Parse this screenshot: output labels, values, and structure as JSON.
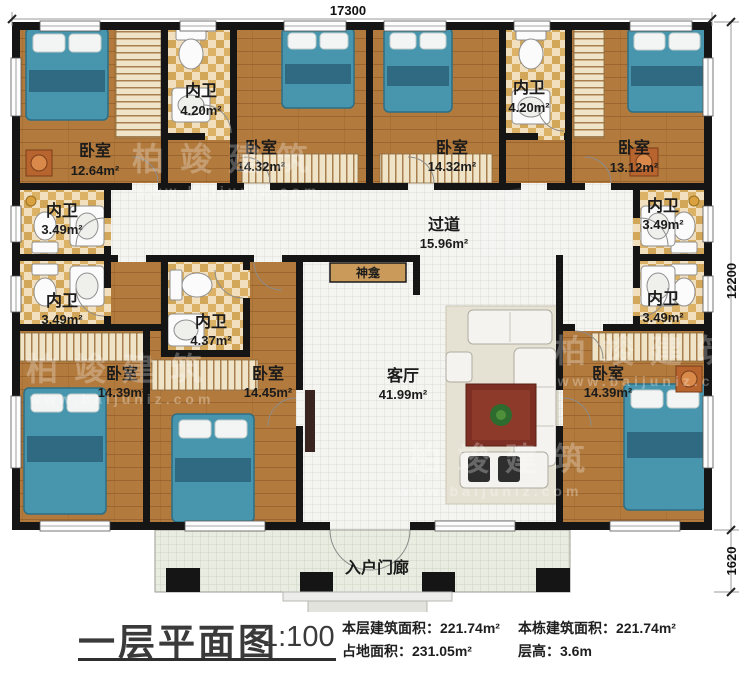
{
  "dims": {
    "top": "17300",
    "right_main": "12200",
    "right_porch": "1620"
  },
  "rooms": {
    "bedroom_tl": {
      "name": "卧室",
      "area": "12.64m²"
    },
    "bath_tl": {
      "name": "内卫",
      "area": "4.20m²"
    },
    "bedroom_t2": {
      "name": "卧室",
      "area": "14.32m²"
    },
    "bedroom_t3": {
      "name": "卧室",
      "area": "14.32m²"
    },
    "bath_tr": {
      "name": "内卫",
      "area": "4.20m²"
    },
    "bedroom_tr": {
      "name": "卧室",
      "area": "13.12m²"
    },
    "bath_l1": {
      "name": "内卫",
      "area": "3.49m²"
    },
    "bath_l2": {
      "name": "内卫",
      "area": "3.49m²"
    },
    "corridor": {
      "name": "过道",
      "area": "15.96m²"
    },
    "shrine": {
      "name": "神龛"
    },
    "bath_mid": {
      "name": "内卫",
      "area": "4.37m²"
    },
    "bedroom_mid": {
      "name": "卧室",
      "area": "14.45m²"
    },
    "living": {
      "name": "客厅",
      "area": "41.99m²"
    },
    "bath_r1": {
      "name": "内卫",
      "area": "3.49m²"
    },
    "bath_r2": {
      "name": "内卫",
      "area": "3.49m²"
    },
    "bedroom_bl": {
      "name": "卧室",
      "area": "14.39m²"
    },
    "bedroom_br": {
      "name": "卧室",
      "area": "14.39m²"
    },
    "porch": {
      "name": "入户门廊"
    }
  },
  "footer": {
    "title": "一层平面图",
    "scale": "1:100",
    "stat1_label": "本层建筑面积：",
    "stat1_value": "221.74m²",
    "stat2_label": "占地面积：",
    "stat2_value": "231.05m²",
    "stat3_label": "本栋建筑面积：",
    "stat3_value": "221.74m²",
    "stat4_label": "层高：",
    "stat4_value": "3.6m"
  },
  "watermark": {
    "brand": "柏竣建筑",
    "url": "www.baijuniz.com"
  },
  "colors": {
    "wood": "#b27a3c",
    "wall": "#151515",
    "bath_tile": "#dcb366",
    "bed": "#4796ad",
    "shrine_bar": "#c99a5a",
    "table_red": "#7e2f23"
  }
}
